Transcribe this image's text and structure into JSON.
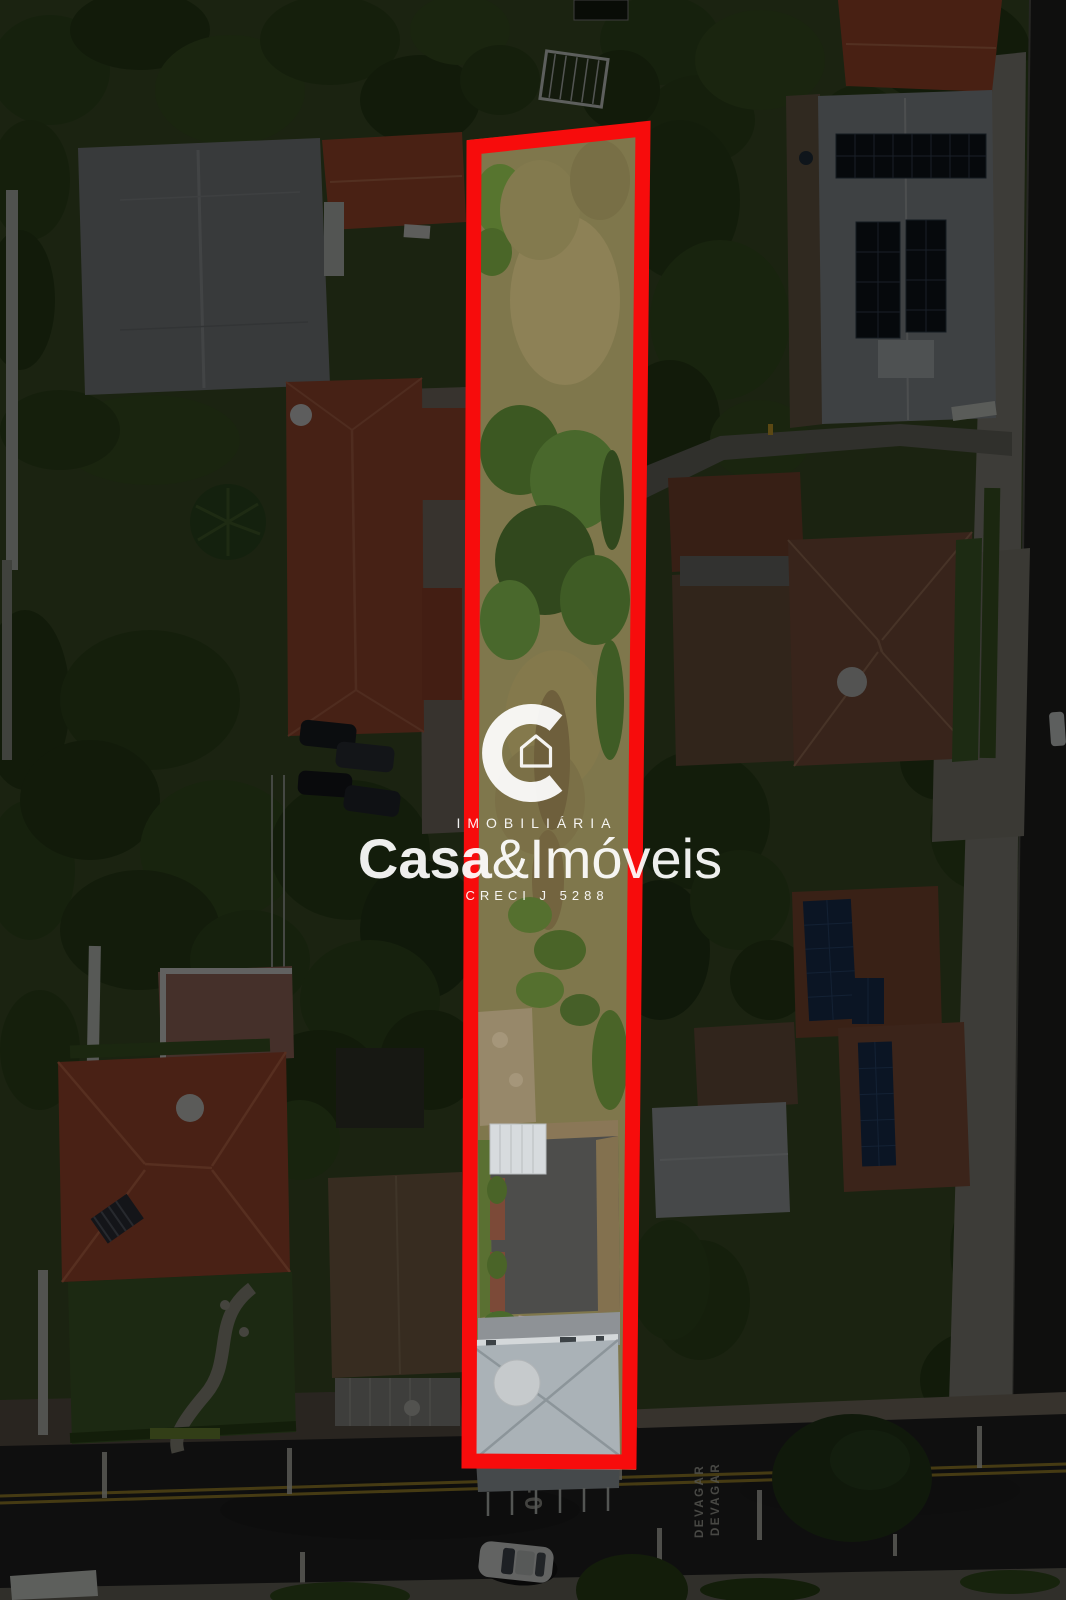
{
  "image_type": "aerial-drone-photo-of-property-lot",
  "watermark": {
    "logo_icon": "c-ring-house-icon",
    "agency_type_label": "IMOBILIÁRIA",
    "brand_bold": "Casa",
    "brand_light": "&Imóveis",
    "license_label": "CRECI J 5288",
    "text_color": "#ffffff"
  },
  "lot_highlight": {
    "outline_color": "#f70c0c"
  },
  "road_markings": {
    "speed_limit_text": "40",
    "slow_text_left": "DEVAGAR",
    "slow_text_right": "DEVAGAR",
    "marking_color": "#c9c9bf"
  }
}
